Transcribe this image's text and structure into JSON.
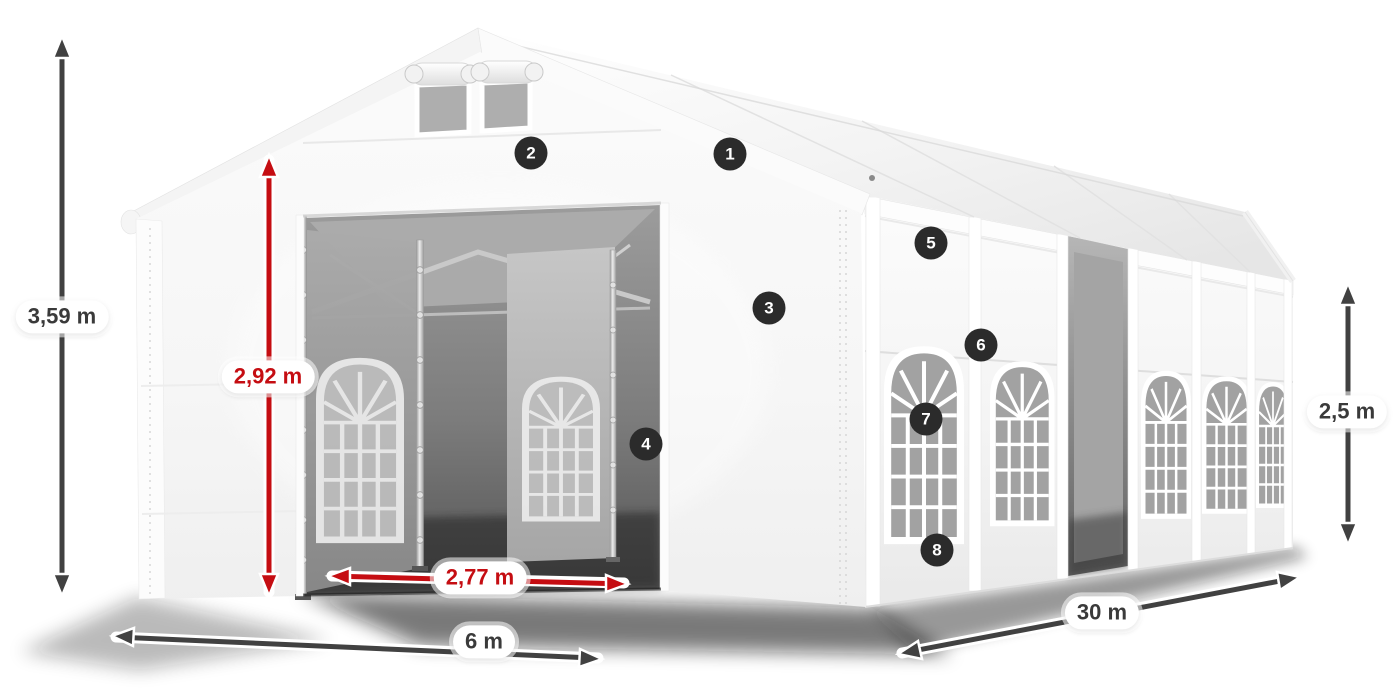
{
  "illustration": {
    "subject": "white-marquee-tent-dimension-diagram"
  },
  "dimensions": {
    "total_height": "3,59 m",
    "entrance_height": "2,92 m",
    "entrance_width": "2,77 m",
    "front_width": "6 m",
    "side_length": "30 m",
    "wall_height": "2,5 m"
  },
  "markers": [
    "1",
    "2",
    "3",
    "4",
    "5",
    "6",
    "7",
    "8"
  ],
  "colors": {
    "dimension_red": "#c50d12",
    "dimension_dark": "#414141",
    "marker_bg": "#2b2b2b",
    "marker_text": "#ffffff",
    "background": "#ffffff"
  }
}
